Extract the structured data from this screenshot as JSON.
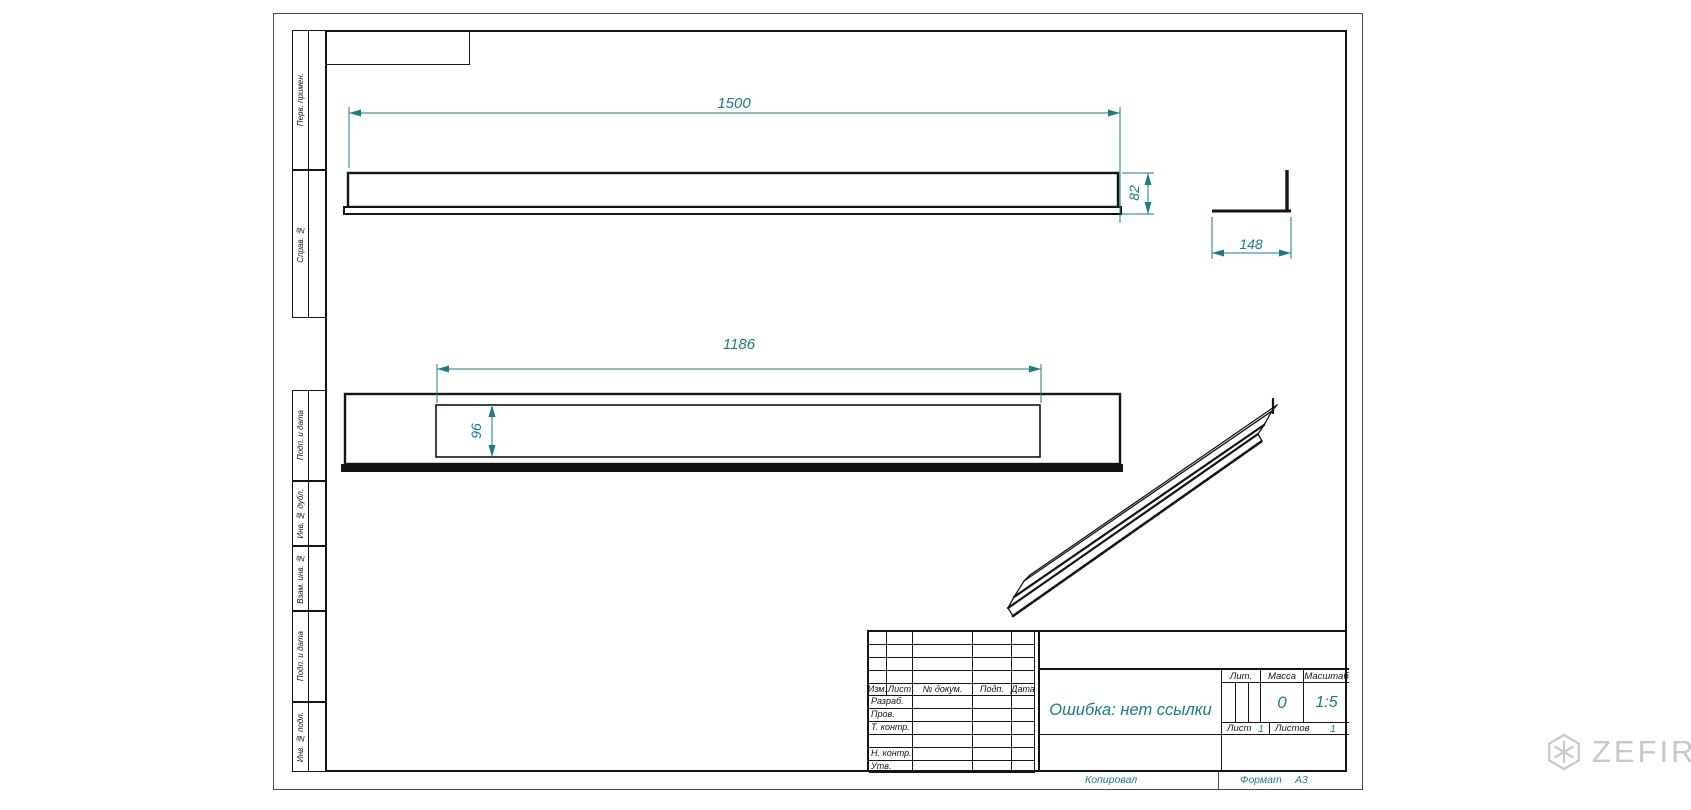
{
  "colors": {
    "accent": "#177d86",
    "line": "#141414",
    "watermark": "#c5c9cc"
  },
  "margin_labels": [
    {
      "label": "Перв. примен."
    },
    {
      "label": "Справ. №"
    },
    {
      "label": "Подп. и дата"
    },
    {
      "label": "Инв. № дубл."
    },
    {
      "label": "Взам. инв. №"
    },
    {
      "label": "Подп. и дата"
    },
    {
      "label": "Инв. № подл."
    }
  ],
  "dimensions": {
    "view1_length": "1500",
    "view1_height": "82",
    "profile_width": "148",
    "view2_length": "1186",
    "view2_slot_height": "96"
  },
  "title_block": {
    "doc_title": "Ошибка: нет ссылки",
    "header_cols": [
      "Изм.",
      "Лист",
      "№ докум.",
      "Подп.",
      "Дата"
    ],
    "left_rows": [
      "Разраб.",
      "Пров.",
      "Т. контр.",
      "",
      "Н. контр.",
      "Утв."
    ],
    "lit_label": "Лит.",
    "mass_label": "Масса",
    "scale_label": "Масштаб",
    "mass_value": "0",
    "scale_value": "1:5",
    "sheet_label": "Лист",
    "sheet_value": "1",
    "sheets_label": "Листов",
    "sheets_value": "1"
  },
  "footer": {
    "copied_label": "Копировал",
    "format_label": "Формат",
    "format_value": "А3"
  },
  "watermark": {
    "text": "ZEFIRE"
  }
}
